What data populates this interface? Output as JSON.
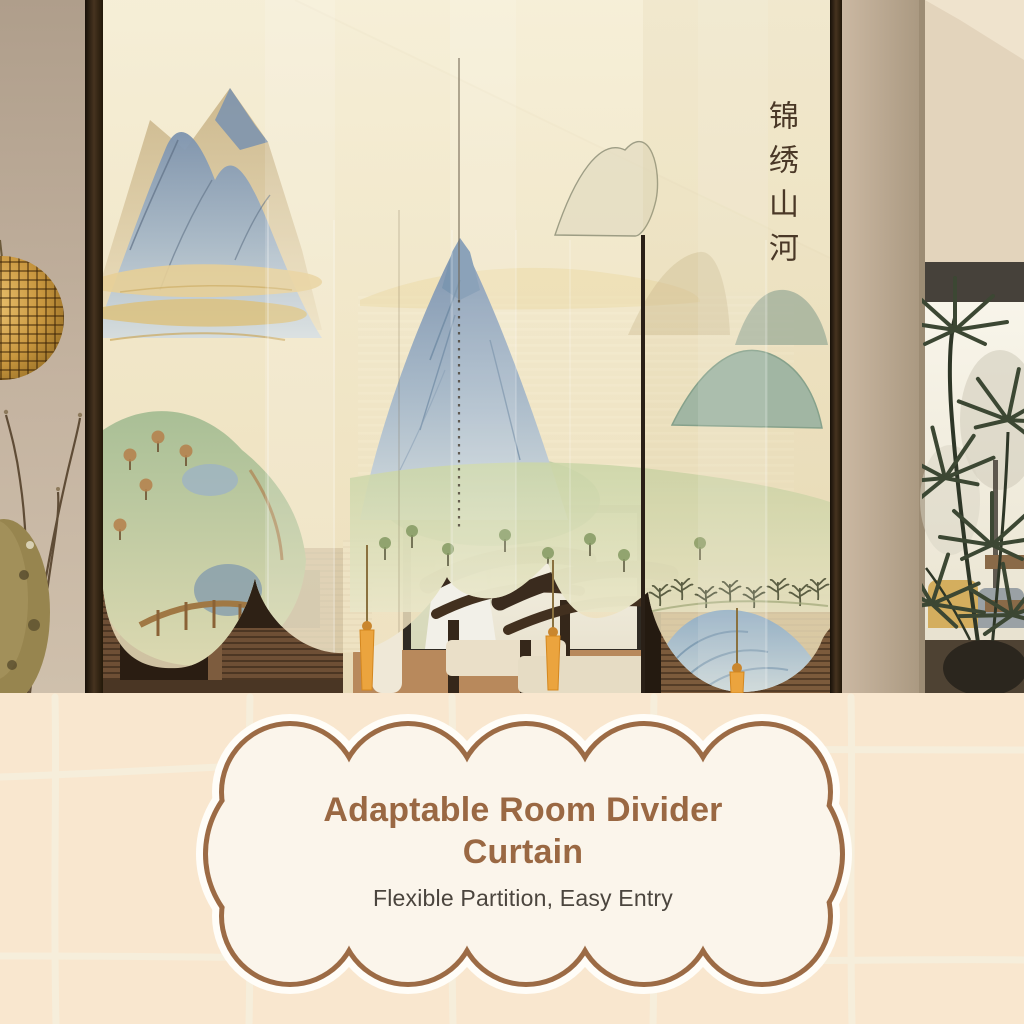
{
  "photo": {
    "calligraphy": {
      "text": "锦绣山河",
      "color": "#4A3827"
    },
    "palette": {
      "curtain_fabric": "#F2E8CE",
      "mountain_blue": "#8AA0B8",
      "mountain_tan": "#CDB88D",
      "meadow_green": "#C9D4A8",
      "wood_dark": "#3A2B1E",
      "tassel_orange": "#E8A43E",
      "lamp_amber": "#D9A553",
      "wall_taupe": "#B7A795"
    }
  },
  "banner": {
    "title": "Adaptable Room Divider Curtain",
    "subtitle": "Flexible Partition, Easy Entry",
    "colors": {
      "background": "#F9E7CF",
      "grid_line": "#F6EEDB",
      "bubble_fill": "#FBF5EB",
      "bubble_border": "#9C6B45",
      "title": "#9A6843",
      "subtitle": "#4B453E"
    }
  }
}
